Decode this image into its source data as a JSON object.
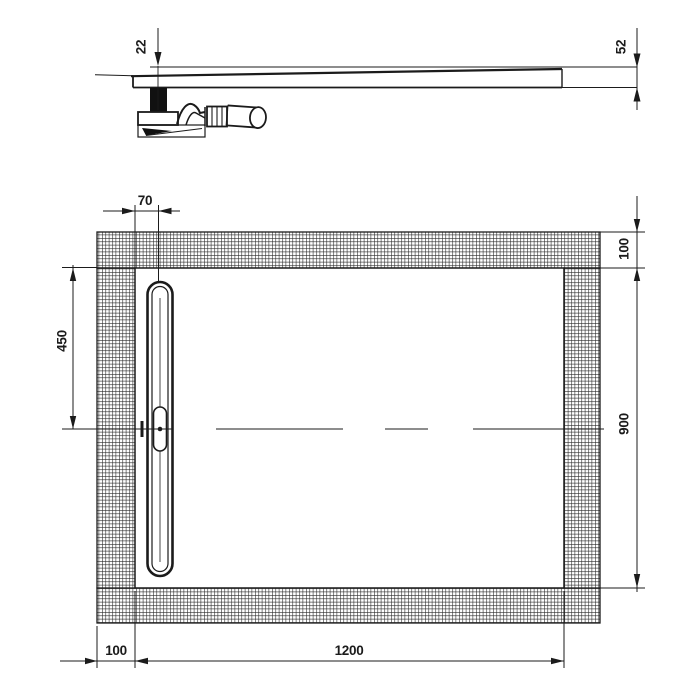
{
  "document": {
    "kind": "technical-drawing",
    "subject": "rectangular shower tray with linear drain and siphon",
    "units": "mm"
  },
  "colors": {
    "ink": "#1b1b1b",
    "paper": "#ffffff"
  },
  "section_view": {
    "dim_depth_at_drain": "22",
    "dim_edge_height": "52"
  },
  "plan_view": {
    "dim_drain_offset": "70",
    "dim_flange_right": "100",
    "dim_drain_from_top": "450",
    "dim_inner_height": "900",
    "dim_flange_left": "100",
    "dim_inner_width": "1200"
  }
}
